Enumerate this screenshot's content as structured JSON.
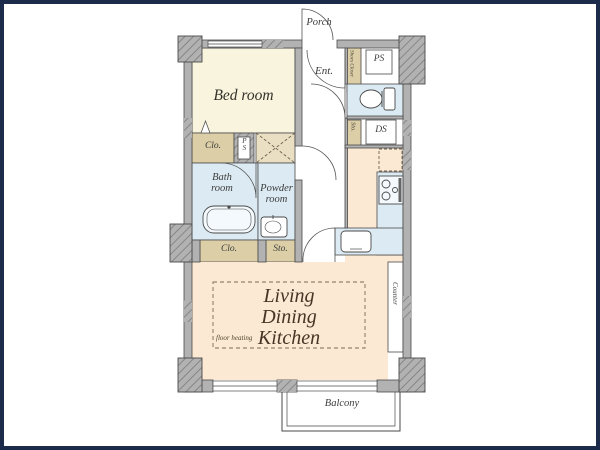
{
  "frame": {
    "border_color": "#1d2b4a"
  },
  "rooms": {
    "porch": {
      "label": "Porch"
    },
    "entrance": {
      "label": "Ent."
    },
    "shoes_closet": {
      "label": "Shoes Closet"
    },
    "pipe_space_top": {
      "label": "PS"
    },
    "bedroom": {
      "label": "Bed room"
    },
    "storage_mid": {
      "label": "Sto."
    },
    "duct_space": {
      "label": "DS"
    },
    "closet_upper": {
      "label": "Clo."
    },
    "pipe_space_small": {
      "label": "PS"
    },
    "bath": {
      "label_line1": "Bath",
      "label_line2": "room"
    },
    "powder": {
      "label_line1": "Powder",
      "label_line2": "room"
    },
    "closet_lower": {
      "label": "Clo."
    },
    "storage_lower": {
      "label": "Sto."
    },
    "ldk": {
      "label_line1": "Living",
      "label_line2": "Dining",
      "label_line3": "Kitchen",
      "note": "floor heating"
    },
    "counter": {
      "label": "Counter"
    },
    "balcony": {
      "label": "Balcony"
    }
  },
  "colors": {
    "wall_fill": "#b2b2b2",
    "wall_outline": "#4a4a4a",
    "bedroom_fill": "#f8f4de",
    "ldk_fill": "#fbe9d3",
    "wet_area_fill": "#dcebf3",
    "closet_fill": "#dccfa7",
    "washer_space_fill": "#eadfc2",
    "label_text": "#3c3c3c",
    "ldk_text": "#463425"
  },
  "icons": {
    "toilet": "toilet-icon",
    "bathtub": "bathtub-icon",
    "powder_sink": "powder-sink-icon",
    "kitchen_sink": "kitchen-sink-icon",
    "stove": "stove-icon",
    "washer_space": "washer-space-icon",
    "door_arc": "door-arc-icon",
    "fridge_space": "fridge-space-dashed"
  }
}
